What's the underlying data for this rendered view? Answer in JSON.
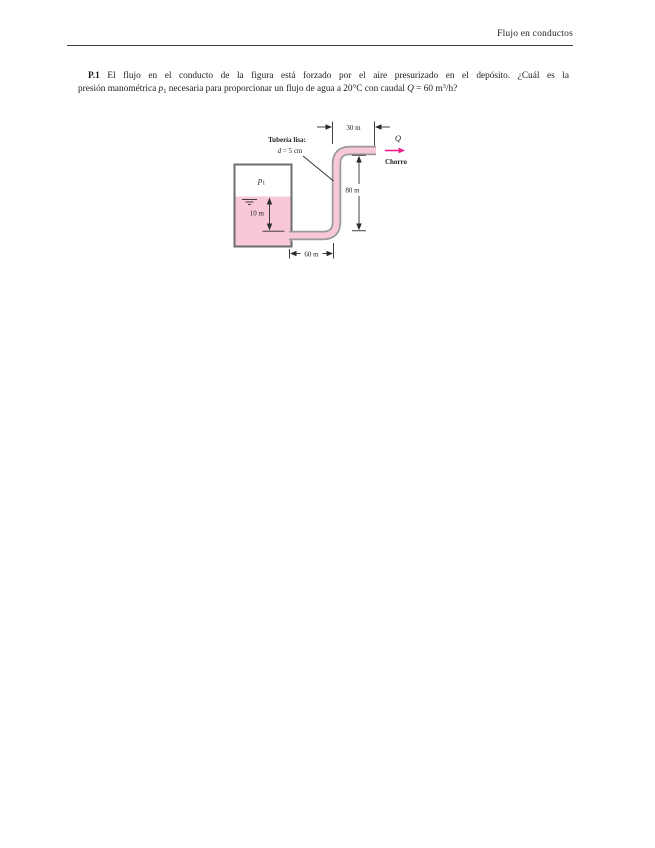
{
  "header": {
    "title": "Flujo en conductos"
  },
  "problem": {
    "number": "P.1",
    "line1_text": " El flujo en el conducto de la figura está forzado por el aire presurizado en el depósito. ¿Cuál es la",
    "line2_pre": "presión manométrica ",
    "p_var": "p",
    "p_sub": "1",
    "line2_mid": " necesaria para proporcionar un flujo de agua a 20°C con caudal ",
    "q_var": "Q",
    "line2_eq": " = 60 m",
    "q_exp": "3",
    "line2_end": "/h?"
  },
  "figure": {
    "pipe_label": "Tubería lisa:",
    "diameter_var": "d",
    "diameter_value": " = 5 cm",
    "dim_top": "30 m",
    "dim_vertical": "80 m",
    "dim_bottom": "60 m",
    "dim_depth": "10 m",
    "pressure_var": "p",
    "pressure_sub": "1",
    "flow_var": "Q",
    "jet_label": "Chorro",
    "colors": {
      "liquid": "#f8c8da",
      "pipe_wall": "#9a9a9a",
      "tank_wall": "#6e6e6e",
      "flow_arrow": "#ed1f8f"
    }
  }
}
